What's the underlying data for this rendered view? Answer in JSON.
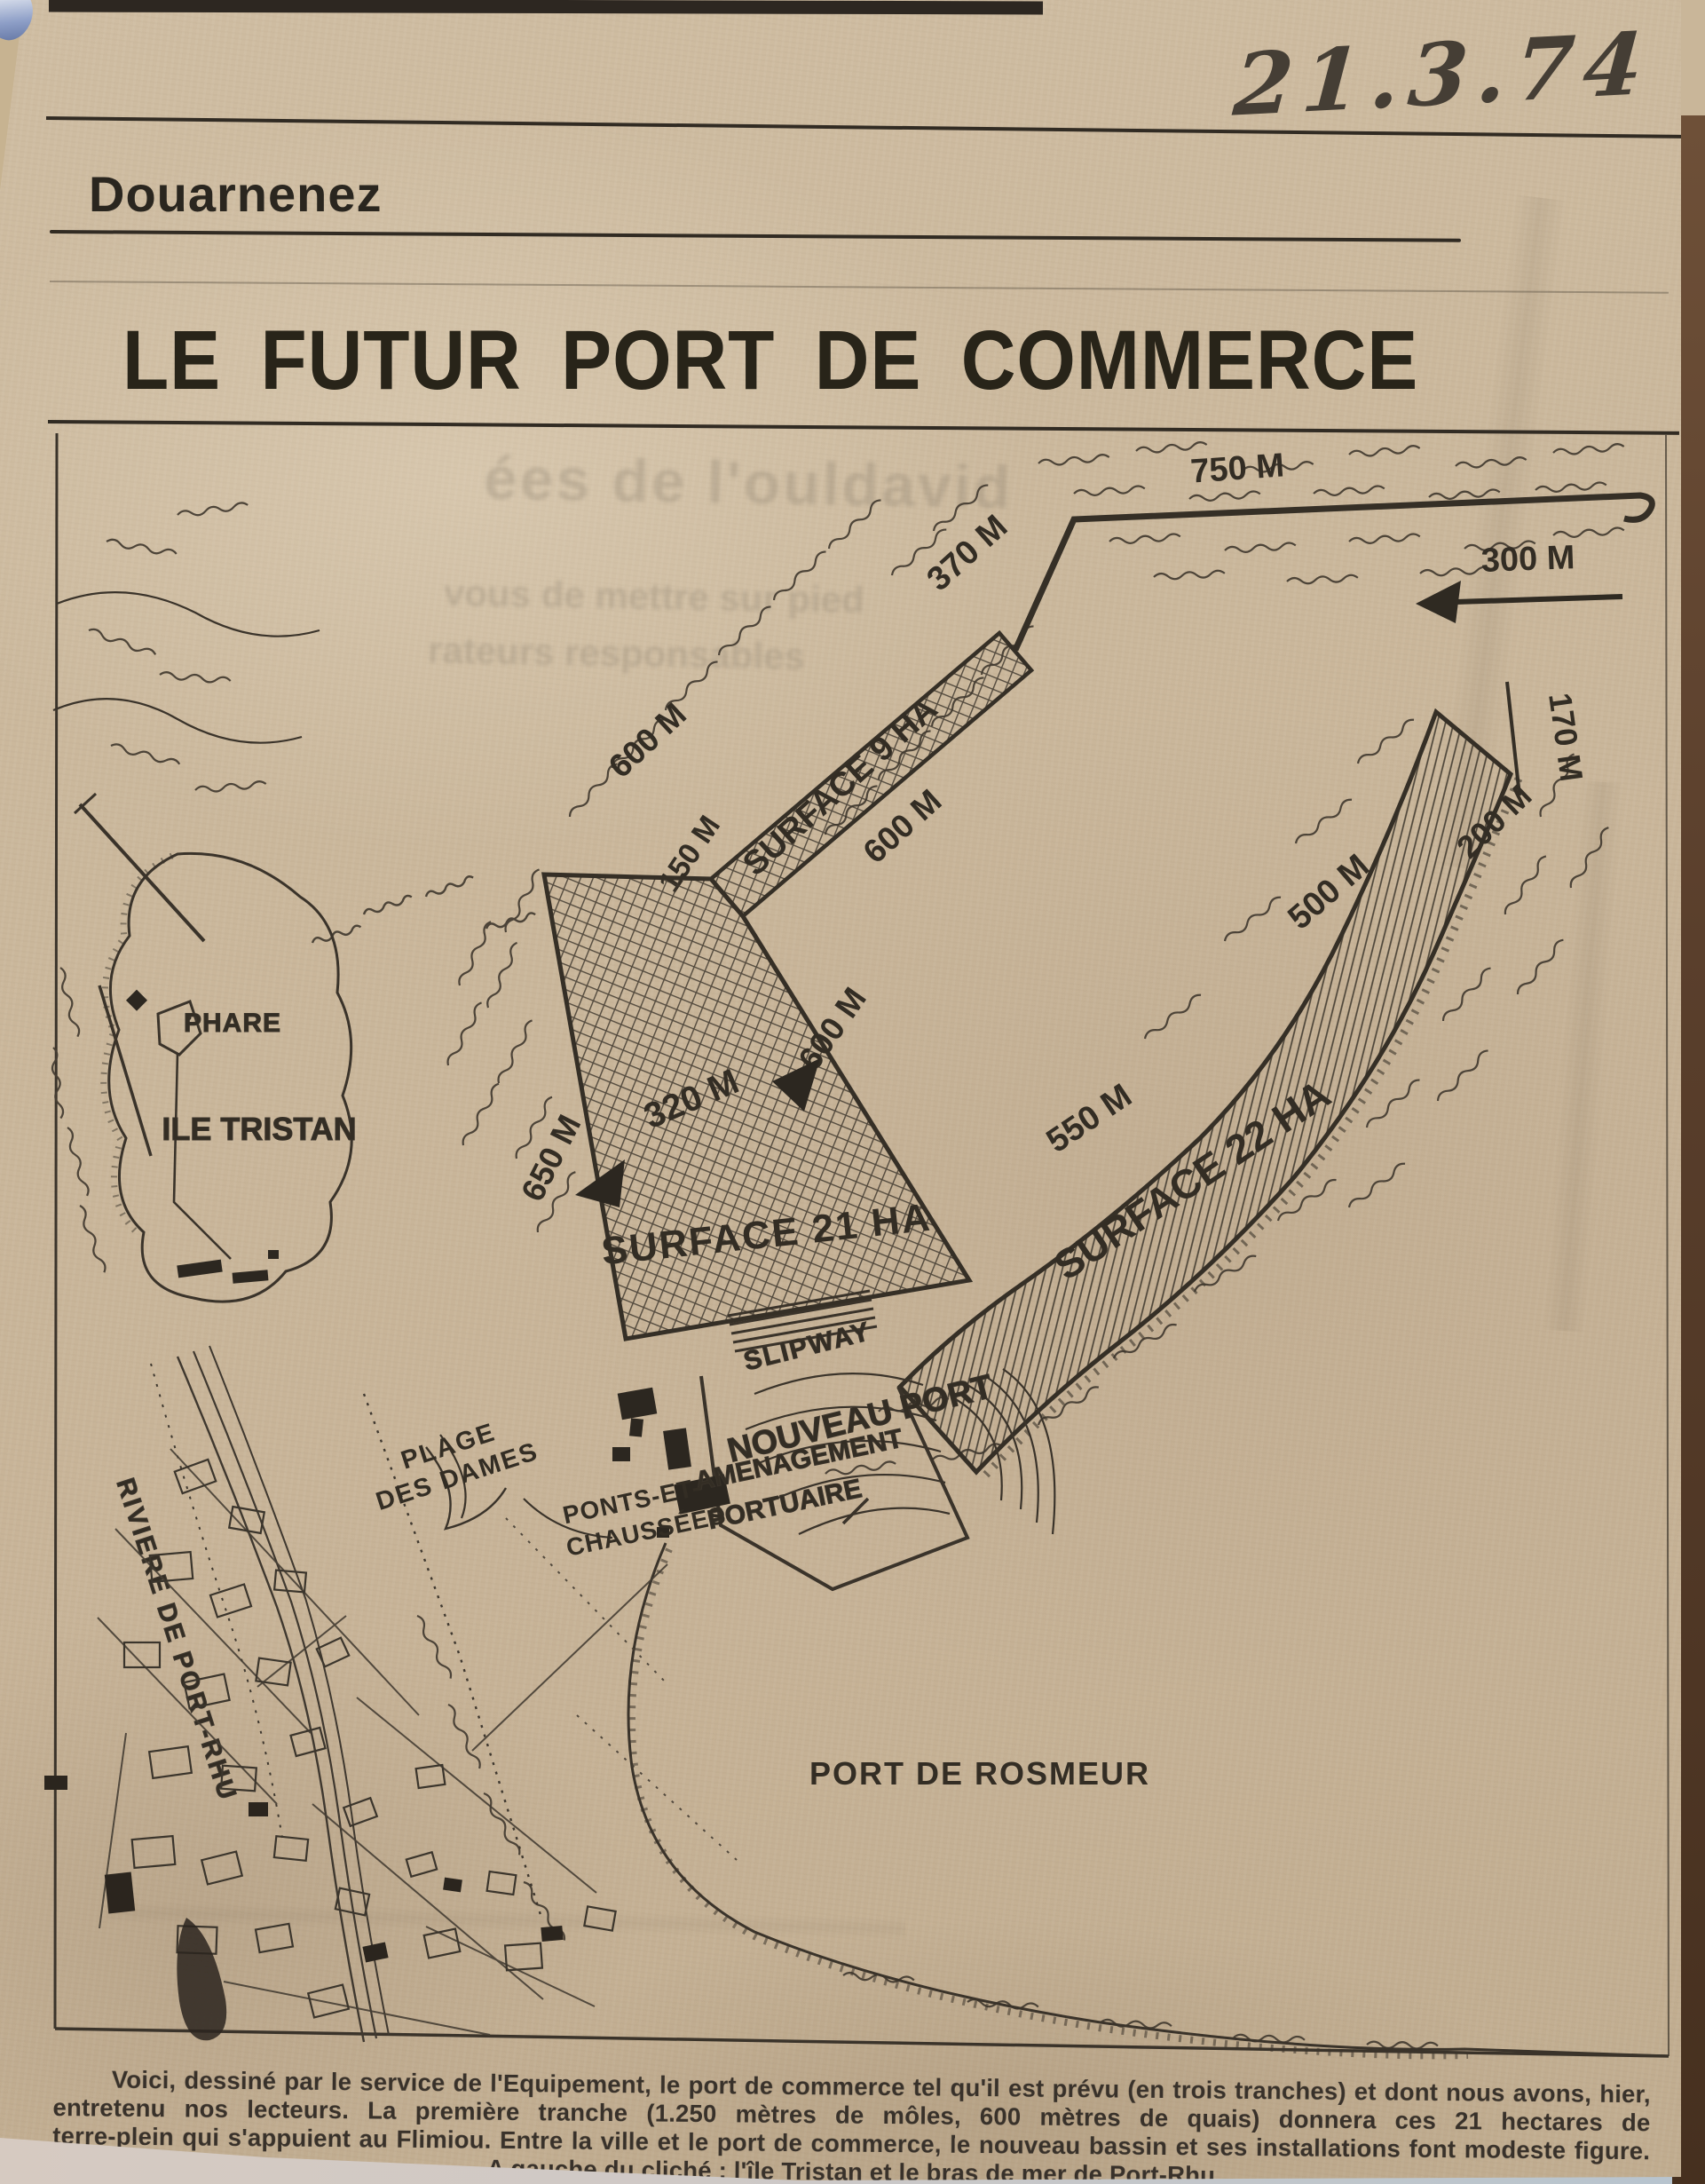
{
  "annotations": {
    "handwritten_date": "21.3.74"
  },
  "masthead": {
    "section": "Douarnenez"
  },
  "headline": "LE FUTUR PORT DE COMMERCE",
  "bleed_through": [
    "ées de l'ouldavid",
    "vous de mettre sur pied",
    "rateurs responsables"
  ],
  "map": {
    "measurements": {
      "m750": "750 M",
      "m370": "370 M",
      "m300": "300 M",
      "m600_nw": "600 M",
      "m150": "150 M",
      "m600_se": "600 M",
      "m600_quay": "600 M",
      "m650": "650 M",
      "m320": "320 M",
      "m170": "170 M",
      "m200": "200 M",
      "m500": "500 M",
      "m550": "550 M"
    },
    "areas": {
      "surface9": "SURFACE 9 HA",
      "surface21": "SURFACE 21 HA",
      "surface22": "SURFACE 22 HA"
    },
    "places": {
      "phare": "PHARE",
      "ile_tristan": "ILE TRISTAN",
      "slipway": "SLIPWAY",
      "nouveau_port": "NOUVEAU PORT",
      "amenagement": "AMENAGEMENT",
      "portuaire": "PORTUAIRE",
      "plage_line1": "PLAGE",
      "plage_line2": "DES DAMES",
      "ponts_line1": "PONTS-ET-",
      "ponts_line2": "CHAUSSÉES",
      "riviere": "RIVIERE DE PORT-RHU",
      "rosmeur": "PORT DE ROSMEUR"
    }
  },
  "caption": {
    "lines": [
      "Voici, dessiné par le service de l'Equipement, le port de commerce tel qu'il est prévu (en trois tranches) et dont nous avons, hier,",
      "entretenu nos lecteurs. La première tranche (1.250 mètres de môles, 600 mètres de quais) donnera ces 21 hectares de",
      "terre-plein qui s'appuient au Flimiou. Entre la ville et le port de commerce, le nouveau bassin et ses installations font modeste figure.",
      "A gauche du cliché : l'île Tristan et le bras de mer de Port-Rhu"
    ]
  }
}
